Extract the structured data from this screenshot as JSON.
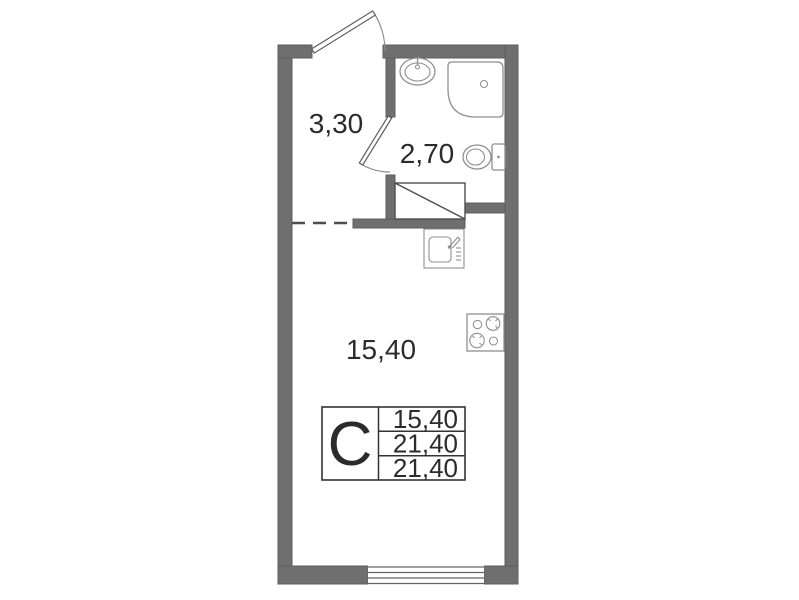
{
  "plan": {
    "rooms": {
      "hallway": {
        "label": "3,30"
      },
      "bathroom": {
        "label": "2,70"
      },
      "living_room": {
        "label": "15,40"
      }
    },
    "info_table": {
      "unit_type": "С",
      "areas": [
        "15,40",
        "21,40",
        "21,40"
      ]
    },
    "icons": {
      "entrance-door-icon": "door-leaf-with-swing-arc",
      "bathroom-door-icon": "door-leaf-with-swing-arc",
      "bath-sink-icon": "oval-basin-with-tap",
      "shower-icon": "corner-tray-with-drain",
      "toilet-icon": "tank-and-bowl",
      "wardrobe-icon": "rectangle-with-diagonal",
      "kitchen-sink-icon": "basin-with-faucet-and-drainboard",
      "stove-icon": "four-burner-hob",
      "window-icon": "multi-line-in-wall"
    },
    "colors": {
      "background": "#ffffff",
      "wall": "#6f6f6f",
      "wall_edge": "#5c5c5c",
      "fixture_line": "#8f8f8f",
      "plan_line": "#4d4d4d",
      "text": "#2b2b2b"
    }
  }
}
